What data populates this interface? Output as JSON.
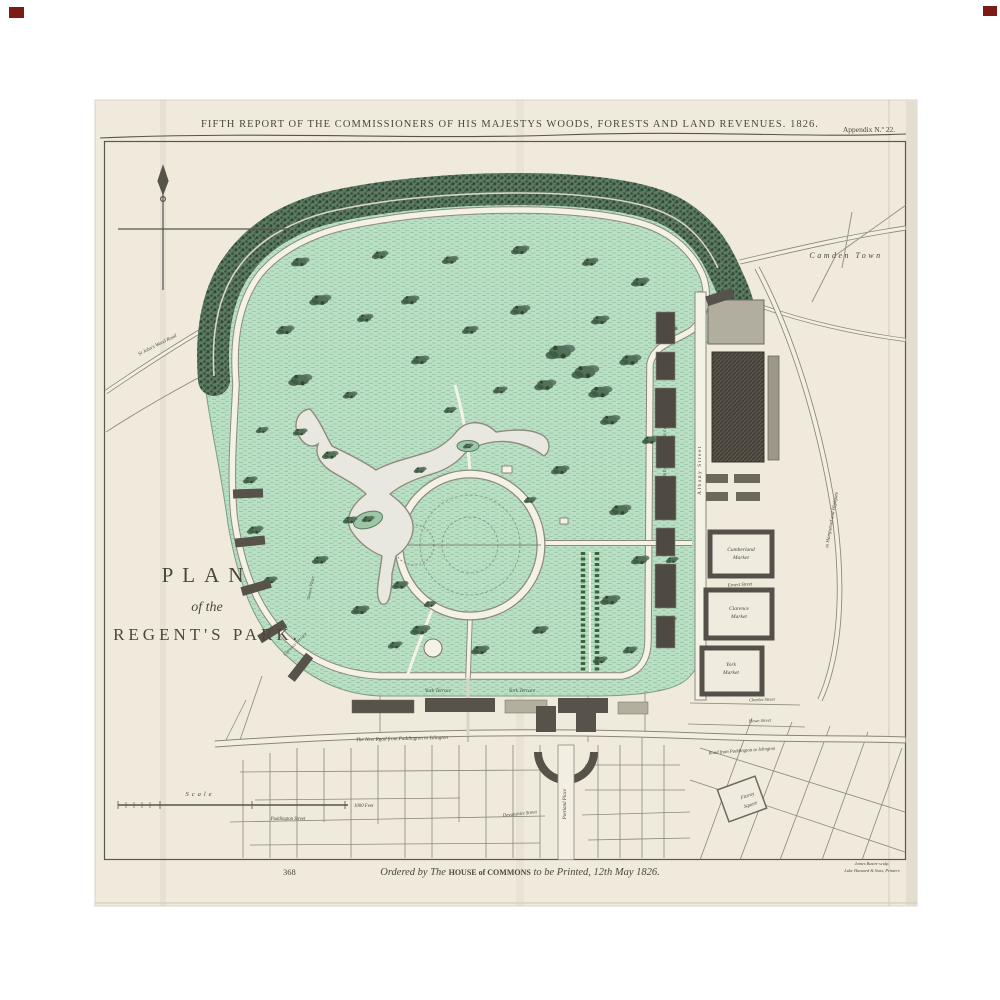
{
  "page": {
    "header_title": "FIFTH REPORT OF THE COMMISSIONERS OF HIS MAJESTYS WOODS, FORESTS AND LAND REVENUES. 1826.",
    "appendix_note": "Appendix N.º 22.",
    "sheet_number": "368",
    "imprint": {
      "part1": "Ordered by The ",
      "part2": "HOUSE of COMMONS",
      "part3": " to be Printed, 12th May 1826."
    },
    "engraver_credit_1": "James Basire sculp.",
    "engraver_credit_2": "Luke Hansard & Sons, Printers"
  },
  "map": {
    "title": {
      "line1": "PLAN",
      "line2": "of the",
      "line3": "REGENT'S PARK."
    },
    "scale": {
      "label": "Scale",
      "unit": "1000 Feet"
    },
    "labels": {
      "camden_town": "Camden Town",
      "st_johns_wood_road": "St John's Wood Road",
      "hampstead_road": "to Hampstead and Highgate",
      "new_road": "The New Road from Paddington to Islington",
      "road_east": "Road from Paddington to Islington",
      "york_terrace_1": "York Terrace",
      "york_terrace_2": "York Terrace",
      "albany_street": "Albany Street",
      "cumberland_terrace": "Cumberland Terrace",
      "barracks": "The Barracks",
      "cumberland_market_1": "Cumberland",
      "cumberland_market_2": "Market",
      "clarence_market_1": "Clarence",
      "clarence_market_2": "Market",
      "york_market_1": "York",
      "york_market_2": "Market",
      "ernest_street": "Ernest Street",
      "portland_place": "Portland Place",
      "devonshire_street": "Devonshire Street",
      "paddington_street": "Paddington Street",
      "fitzroy_square_1": "Fitzroy",
      "fitzroy_square_2": "Square",
      "charles_street": "Charles Street",
      "howe_street": "Howe Street",
      "sussex_place": "Sussex Place",
      "clarence_terrace": "Clarence Terrace"
    },
    "colors": {
      "paper": "#efeadc",
      "park_green": "#b9dfc4",
      "belt_green": "#4a6550",
      "water": "#e9e8e0",
      "road": "#f4f1e6",
      "block_gray": "#b2ae9f",
      "block_dark": "#55514a",
      "ink": "#3e3c34",
      "registration_red": "#7e1a15"
    }
  }
}
